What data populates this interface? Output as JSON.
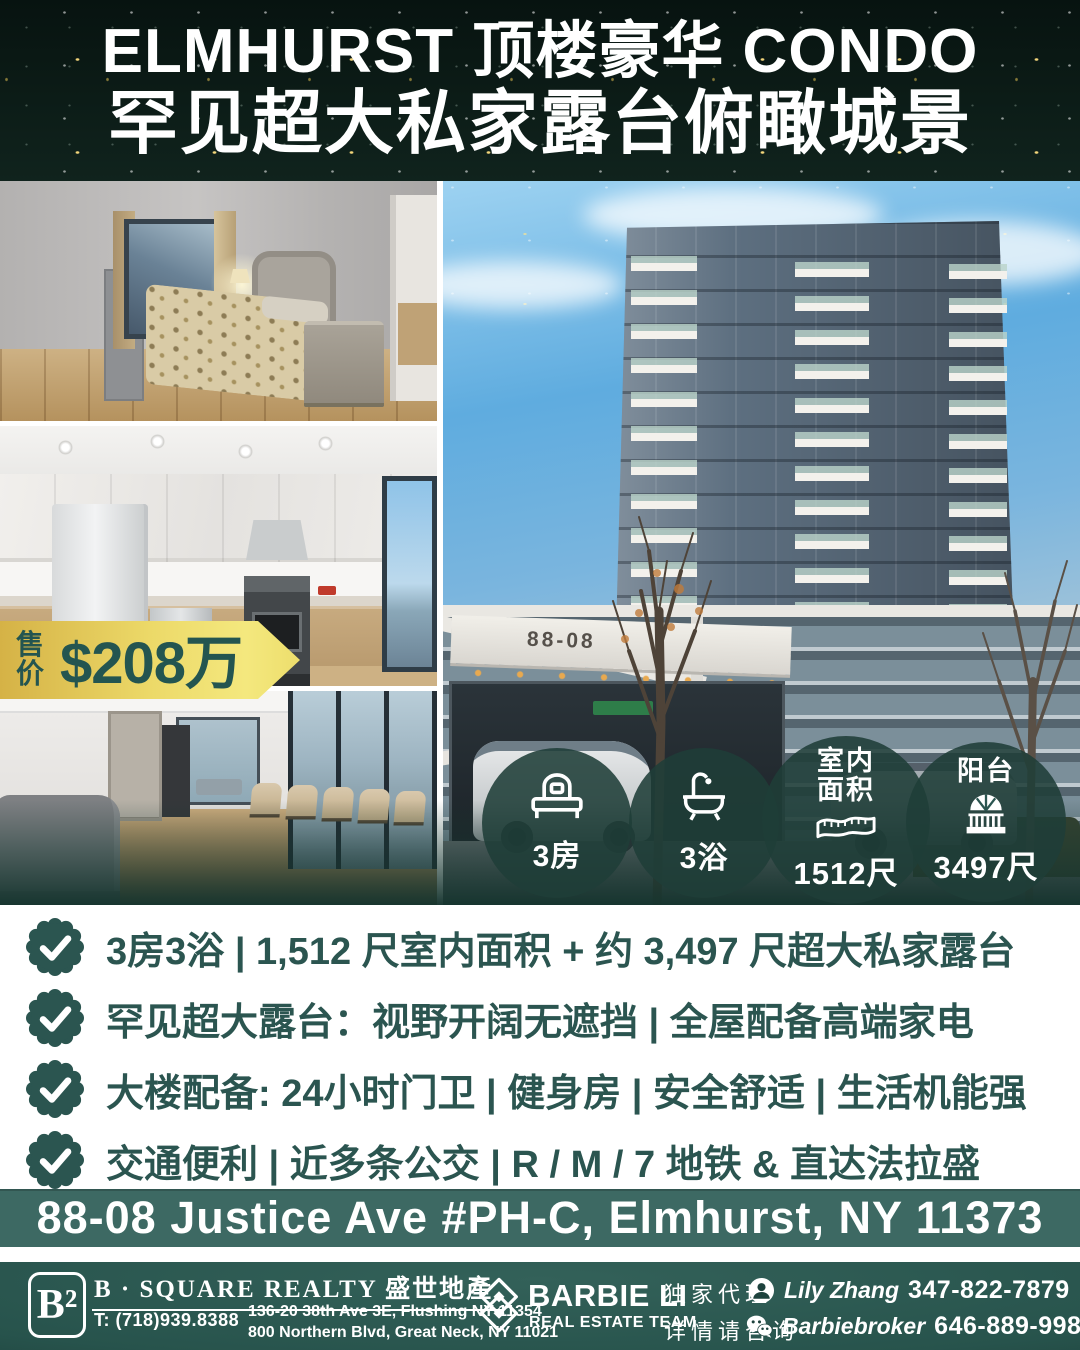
{
  "header": {
    "line1": "ELMHURST 顶楼豪华 CONDO",
    "line2": "罕见超大私家露台俯瞰城景"
  },
  "price": {
    "label": "售价",
    "value": "$208万"
  },
  "building": {
    "sign": "88-08"
  },
  "badges": [
    {
      "icon": "bed-icon",
      "label": "3房"
    },
    {
      "icon": "bathtub-icon",
      "label": "3浴"
    },
    {
      "icon": "tape-measure-icon",
      "title_line1": "室内",
      "title_line2": "面积",
      "value": "1512尺"
    },
    {
      "icon": "balcony-icon",
      "title": "阳台",
      "value": "3497尺"
    }
  ],
  "features": [
    "3房3浴 | 1,512 尺室内面积 + 约 3,497 尺超大私家露台",
    "罕见超大露台：视野开阔无遮挡 | 全屋配备高端家电",
    "大楼配备: 24小时门卫 | 健身房 | 安全舒适 | 生活机能强",
    "交通便利 | 近多条公交 | R / M / 7 地铁 & 直达法拉盛"
  ],
  "address": {
    "text": "88-08 Justice Ave #PH-C, Elmhurst, NY 11373"
  },
  "footer": {
    "bsquare": {
      "logo": "B²",
      "name": "B · SQUARE REALTY 盛世地產",
      "phone": "T: (718)939.8388",
      "address1": "136-20 38th Ave 3E, Flushing NY 11354",
      "address2": "800 Northern Blvd, Great Neck, NY 11021"
    },
    "barbie": {
      "name": "BARBIE LI",
      "sub": "REAL ESTATE TEAM"
    },
    "exclusive": {
      "line1": "独家代理",
      "line2": "详情请咨询"
    },
    "contacts": [
      {
        "icon": "person-icon",
        "name": "Lily Zhang",
        "phone": "347-822-7879"
      },
      {
        "icon": "wechat-icon",
        "name": "Barbiebroker",
        "phone": "646-889-9988"
      }
    ]
  },
  "colors": {
    "header_bg": "#0c1c17",
    "accent_teal": "#2b5550",
    "badge_bg": "rgba(31,62,56,0.88)",
    "ribbon_gold": "#ecd968",
    "address_bar_bg": "#3d6963",
    "footer_bg": "#27534c",
    "star_gold": "#ffdf80"
  }
}
